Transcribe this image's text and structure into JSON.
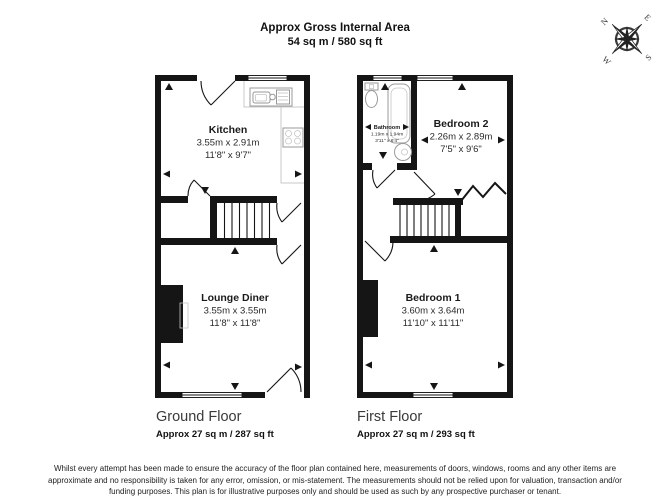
{
  "header": {
    "title": "Approx Gross Internal Area",
    "subtitle": "54 sq m / 580 sq ft"
  },
  "compass": {
    "n": "N",
    "e": "E",
    "s": "S",
    "w": "W"
  },
  "ground_floor": {
    "label": "Ground Floor",
    "area": "Approx 27 sq m / 287 sq ft",
    "rooms": {
      "kitchen": {
        "name": "Kitchen",
        "metric": "3.55m x 2.91m",
        "imperial": "11'8\" x 9'7\""
      },
      "lounge_diner": {
        "name": "Lounge Diner",
        "metric": "3.55m x 3.55m",
        "imperial": "11'8\" x 11'8\""
      }
    }
  },
  "first_floor": {
    "label": "First Floor",
    "area": "Approx 27 sq m / 293 sq ft",
    "rooms": {
      "bathroom": {
        "name": "Bathroom",
        "metric": "1.19m x 1.94m",
        "imperial": "3'11\" x 6'4\""
      },
      "bedroom2": {
        "name": "Bedroom 2",
        "metric": "2.26m x 2.89m",
        "imperial": "7'5\" x 9'6\""
      },
      "bedroom1": {
        "name": "Bedroom 1",
        "metric": "3.60m x 3.64m",
        "imperial": "11'10\" x 11'11\""
      }
    }
  },
  "icons": {
    "compass": "compass-rose",
    "measurement_arrow": "black-triangle",
    "window": "double-line-opening",
    "door": "quarter-arc-swing",
    "stairs": "tread-lines"
  },
  "disclaimer": "Whilst every attempt has been made to ensure the accuracy of the floor plan contained here, measurements of doors, windows, rooms and any other items are approximate and no responsibility is taken for any error, omission, or mis-statement. The measurements should not be relied upon for valuation, transaction and/or funding purposes. This plan is for illustrative purposes only and should be used as such by any prospective purchaser or tenant."
}
